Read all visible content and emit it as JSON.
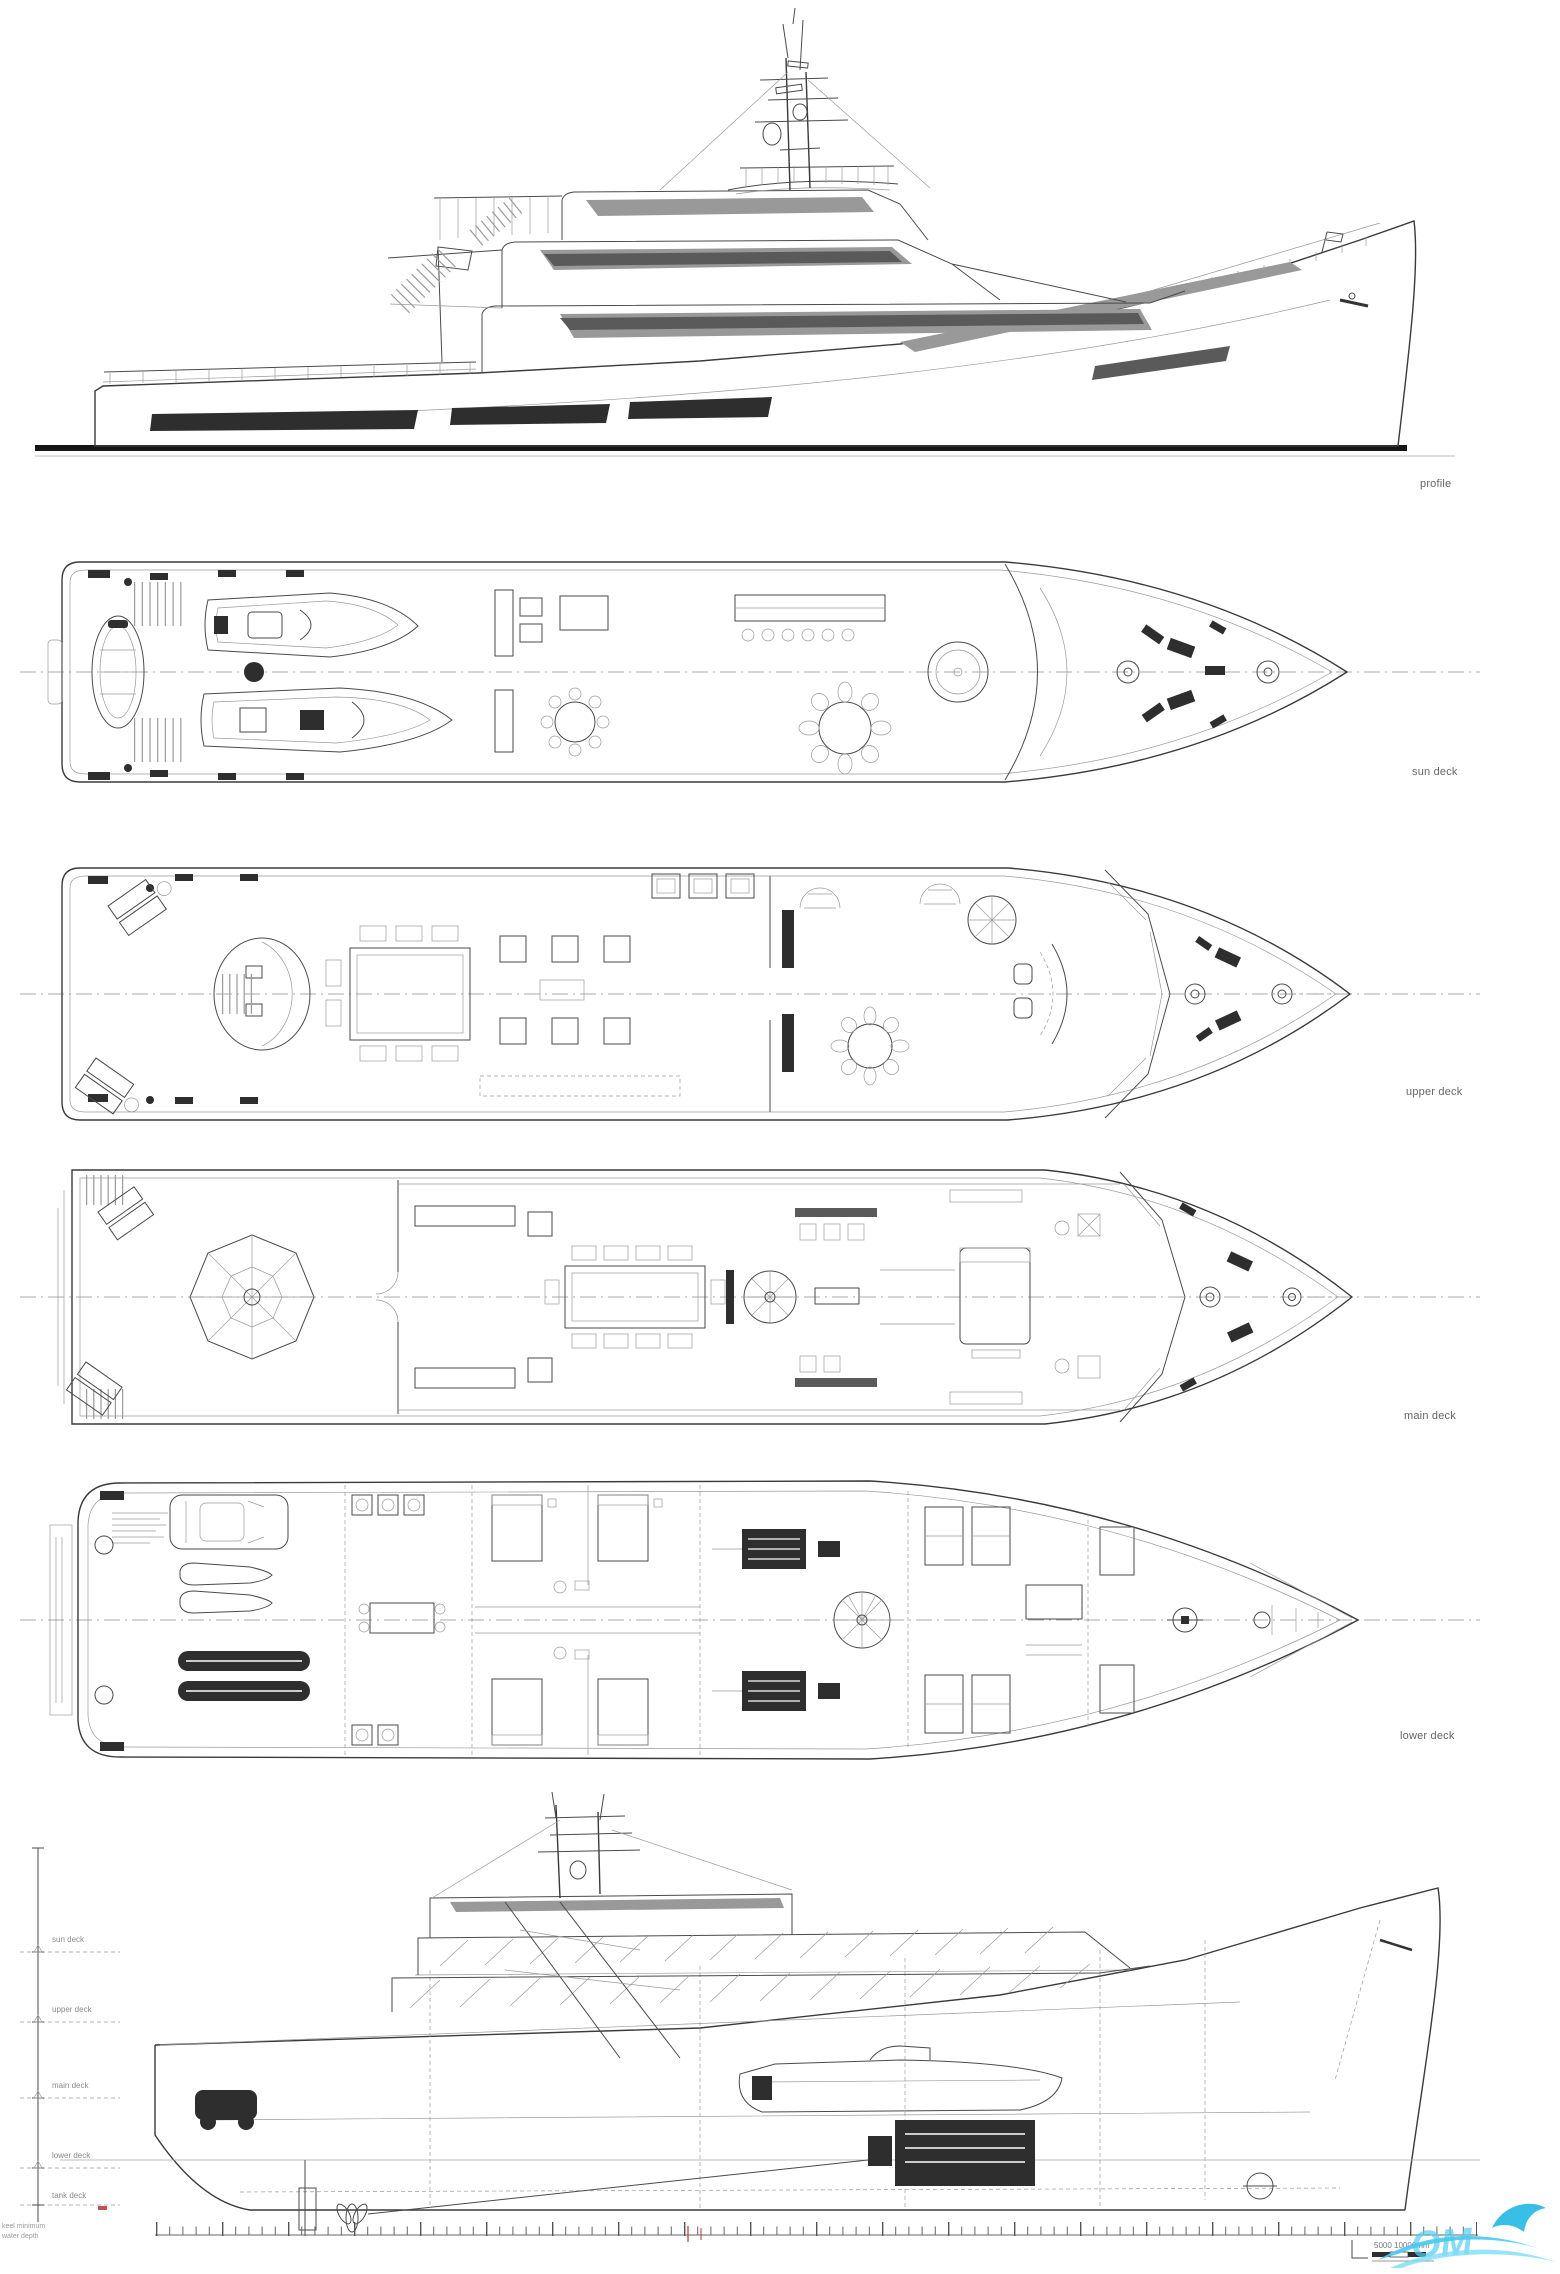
{
  "page": {
    "background": "#ffffff"
  },
  "views": [
    {
      "id": "profile",
      "label": "profile"
    },
    {
      "id": "sun_deck",
      "label": "sun deck"
    },
    {
      "id": "upper_deck",
      "label": "upper deck"
    },
    {
      "id": "main_deck",
      "label": "main deck"
    },
    {
      "id": "lower_deck",
      "label": "lower deck"
    },
    {
      "id": "inboard_profile",
      "label": ""
    }
  ],
  "dimension_ladder": {
    "labels": [
      "sun deck",
      "upper deck",
      "main deck",
      "lower deck",
      "tank deck"
    ],
    "footnotes": [
      "keel minimum",
      "water depth"
    ]
  },
  "scale_bar": {
    "label": "5000   10000mm"
  },
  "watermark": {
    "fragment": "OM",
    "color": "#55cef2"
  },
  "colors": {
    "line": "#4a4a4a",
    "light_line": "#9a9a9a",
    "dark_fill": "#2e2e2e",
    "waterline": "#151515",
    "watermark_cyan": "#55cef2",
    "accent_red": "#c03030"
  }
}
